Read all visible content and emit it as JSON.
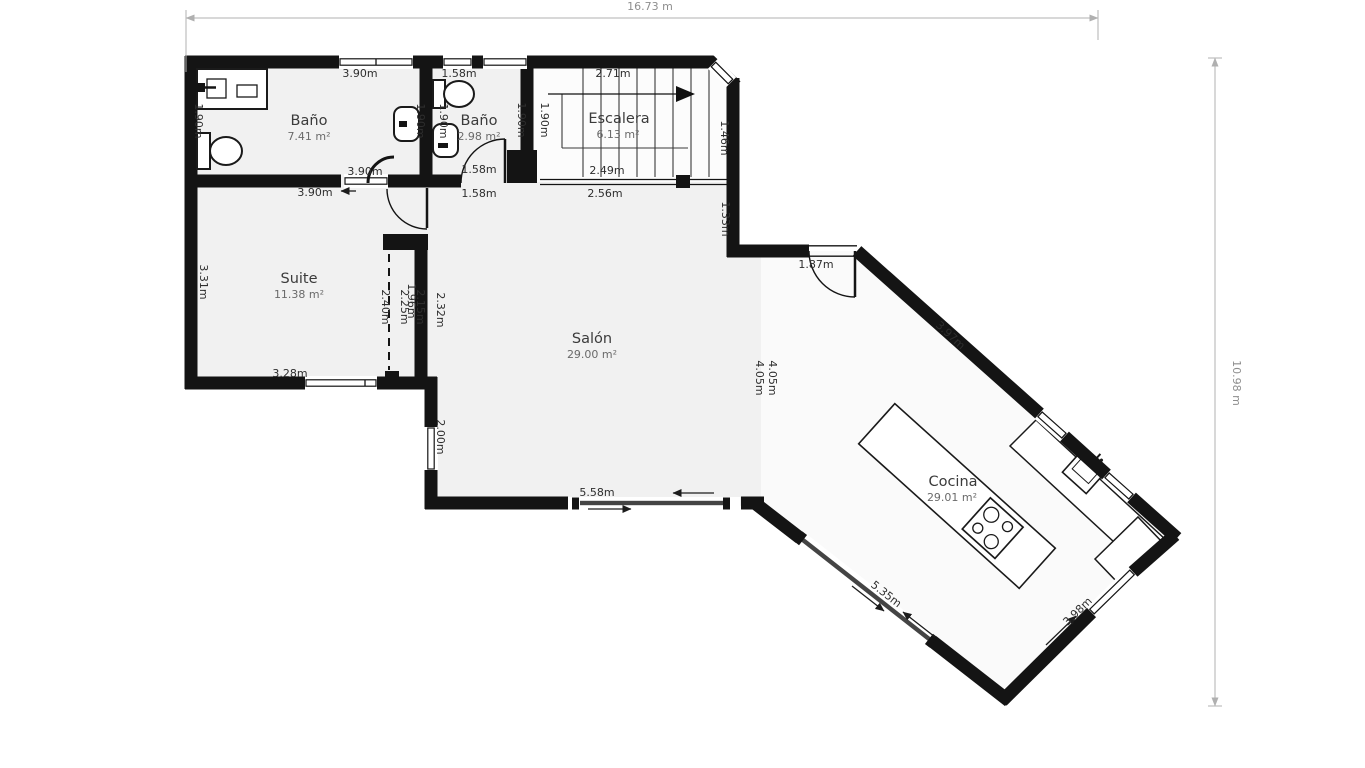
{
  "overall": {
    "width": "16.73 m",
    "height": "10.98 m"
  },
  "rooms": {
    "bano1": {
      "name": "Baño",
      "area": "7.41 m²"
    },
    "bano2": {
      "name": "Baño",
      "area": "2.98 m²"
    },
    "escalera": {
      "name": "Escalera",
      "area": "6.13 m²"
    },
    "suite": {
      "name": "Suite",
      "area": "11.38 m²"
    },
    "salon": {
      "name": "Salón",
      "area": "29.00 m²"
    },
    "cocina": {
      "name": "Cocina",
      "area": "29.01 m²"
    }
  },
  "dims": {
    "bano1_top": "3.90m",
    "bano1_bottom": "3.90m",
    "hall": "3.90m",
    "bano1_left": "1.90m",
    "bano1_right": "1.90m",
    "bano2_left": "1.90m",
    "bano2_top": "1.58m",
    "bano2_bottom": "1.58m",
    "bano2_below": "1.58m",
    "esc_left_outer": "1.90m",
    "esc_left_inner": "1.90m",
    "esc_top": "2.71m",
    "esc_bottom": "2.49m",
    "esc_below": "2.56m",
    "chamfer": "1.46m",
    "hall_right": "1.33m",
    "suite_left": "3.31m",
    "suite_bottom": "3.28m",
    "wardrobe_opening": "2.40m",
    "wardrobe_a": "2.25m",
    "wardrobe_b": "1.96m",
    "wardrobe_c": "2.15m",
    "wardrobe_wall": "2.32m",
    "salon_left": "2.00m",
    "salon_bottom": "5.58m",
    "boundary_a": "4.05m",
    "boundary_b": "4.05m",
    "kitchen_door": "1.87m",
    "kitchen_ne": "3.97m",
    "kitchen_sw": "5.35m",
    "kitchen_se": "3.98m"
  }
}
